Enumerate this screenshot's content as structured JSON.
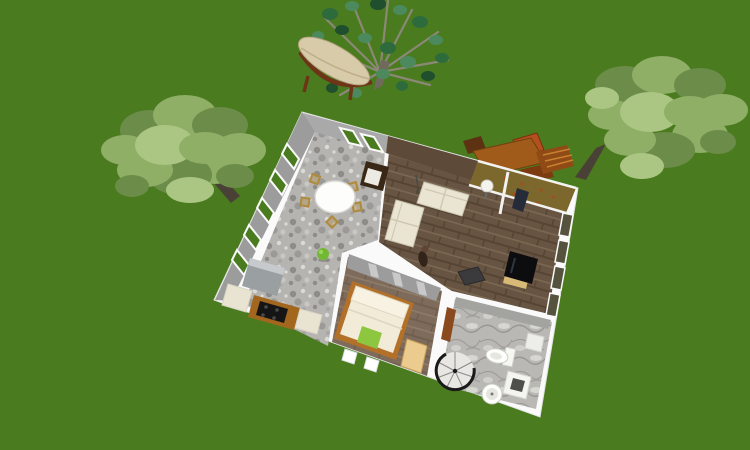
{
  "colors": {
    "grass": "#4a7c1f",
    "wall-white": "#fafafa",
    "wall-edge": "#e2e2e2",
    "wall-face": "#9c9c9c",
    "wall-face-light": "#a9a9a9",
    "brick-face": "#5e4a38",
    "stone-base": "#b5b4b1",
    "stone-dark": "#8d8c89",
    "stone-light": "#dadad6",
    "wood-base": "#685442",
    "wood-dark": "#574534",
    "wood-light": "#7b6852",
    "marble-base": "#b9b8b4",
    "marble-vein": "#908f8b",
    "marble-light": "#dededa",
    "sofa": "#eae5d3",
    "sofa-line": "#cfc9b2",
    "bed-linen": "#f1ebd8",
    "bed-pillowtop": "#f7f2e2",
    "bed-frame": "#b37029",
    "pillow-green": "#8dc63f",
    "bench-tan": "#eccb8e",
    "tv-stand": "#d9b977",
    "tv-black": "#0d0d0f",
    "box-dark": "#3b3b3d",
    "desk-olive": "#7c682c",
    "desk-speckle": "#a34d22",
    "navy-chair": "#262b3a",
    "lamp-white": "#f5f3ee",
    "sage-window": "#55523e",
    "door-brown": "#8a4a1e",
    "chair-gold": "#b08a3c",
    "chair-darkwood": "#3a2817",
    "cushion-white": "#eceae2",
    "ball-green": "#72b832",
    "fridge-gray": "#9aa0a2",
    "fridge-top": "#c6cacc",
    "counter-cream": "#e9e4d2",
    "counter-wood": "#a2661f",
    "cooktop-black": "#151515",
    "foliage-light": "#8fae66",
    "foliage-mid": "#6c8c4a",
    "foliage-highlight": "#abc682",
    "foliage-dark1": "#2e6b3c",
    "foliage-dark2": "#4c8a5e",
    "foliage-dark3": "#1f4f2c",
    "branch-gray": "#8b8878",
    "trunk-brown": "#4a4136",
    "outdoor-wood": "#a05a1a",
    "outdoor-wood-dark": "#7c3a10",
    "outdoor-red": "#b4501e",
    "outdoor-slat": "#c8812f",
    "hammock-canvas": "#d7cbaa",
    "hammock-frame": "#6e3418",
    "fixture-white": "#fdfdfb",
    "fixture-shade": "#e6e6e1",
    "stair-dark": "#1a1a1a",
    "stair-light": "#e8e7e3"
  },
  "scene": {
    "view": "aerial-3d-render",
    "canvas": {
      "width": 750,
      "height": 450
    },
    "outdoor": {
      "objects": [
        "lawn",
        "deciduous-tree-left",
        "deciduous-tree-right",
        "sparse-tree-top",
        "hammock",
        "outdoor-dining-table",
        "outdoor-chairs"
      ]
    },
    "house": {
      "rooms": [
        {
          "name": "kitchen-dining",
          "floor": "stone-mosaic",
          "objects": [
            "round-dining-table",
            "dining-chairs",
            "dark-armchair",
            "refrigerator",
            "kitchen-counters",
            "cooktop",
            "green-ball"
          ]
        },
        {
          "name": "living-room",
          "floor": "dark-wood",
          "objects": [
            "l-shaped-sofa",
            "floor-lamp",
            "figurine",
            "dark-coffee-table",
            "tv-stand",
            "tv",
            "desk-with-lamp",
            "desk-chair"
          ]
        },
        {
          "name": "bedroom",
          "floor": "wood",
          "objects": [
            "double-bed",
            "green-pillow",
            "bedside-bench"
          ]
        },
        {
          "name": "bathroom",
          "floor": "marble",
          "objects": [
            "spiral-staircase",
            "toilet",
            "pedestal-sink",
            "shower",
            "interior-door",
            "wall-shelf"
          ]
        }
      ],
      "windows": {
        "west-wall": 5,
        "north-wall": 2,
        "east-wall": 4
      }
    }
  }
}
